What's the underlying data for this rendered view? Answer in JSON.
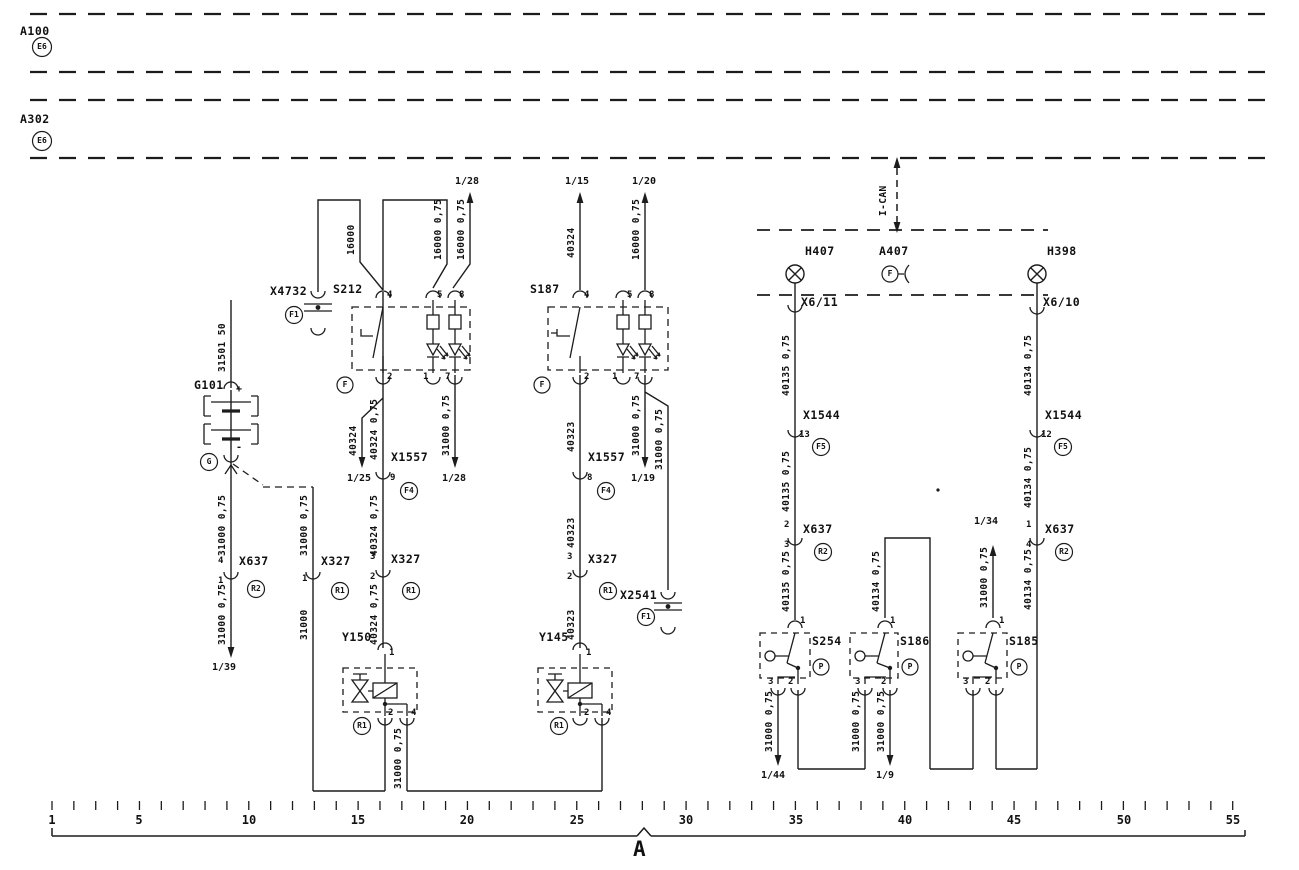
{
  "harness": {
    "a100": "A100",
    "a100_code": "E6",
    "a302": "A302",
    "a302_code": "E6",
    "ican": "I-CAN"
  },
  "page": {
    "marker": "A"
  },
  "ruler": {
    "labels": [
      "1",
      "5",
      "10",
      "15",
      "20",
      "25",
      "30",
      "35",
      "40",
      "45",
      "50",
      "55"
    ]
  },
  "lamps": {
    "h407": "H407",
    "h398": "H398",
    "a407": "A407",
    "a407_code": "F"
  },
  "connectors": {
    "x4732": {
      "label": "X4732",
      "code": "F1"
    },
    "x2541": {
      "label": "X2541",
      "code": "F1"
    },
    "x6_11": "X6/11",
    "x6_10": "X6/10",
    "x1557_l": {
      "label": "X1557",
      "pin": "9",
      "code": "F4"
    },
    "x1557_r": {
      "label": "X1557",
      "pin": "8",
      "code": "F4"
    },
    "x327_g": {
      "label": "X327",
      "pin": "1",
      "code": "R1"
    },
    "x327_l": {
      "label": "X327",
      "pin_in": "3",
      "pin_out": "2",
      "code": "R1"
    },
    "x327_r": {
      "label": "X327",
      "pin_in": "3",
      "pin_out": "2",
      "code": "R1"
    },
    "x637_g": {
      "label": "X637",
      "pin_in": "4",
      "pin_out": "1",
      "code": "R2"
    },
    "x637_m": {
      "label": "X637",
      "pin_in": "2",
      "pin_out": "3",
      "code": "R2"
    },
    "x637_r": {
      "label": "X637",
      "pin_in": "1",
      "pin_out": "4",
      "code": "R2"
    },
    "x1544_l": {
      "label": "X1544",
      "pin": "13",
      "code": "F5"
    },
    "x1544_r": {
      "label": "X1544",
      "pin": "12",
      "code": "F5"
    }
  },
  "components": {
    "g101": {
      "label": "G101",
      "code": "G",
      "plus": "+",
      "minus": "-"
    },
    "s212": {
      "label": "S212",
      "code": "F",
      "p4": "4",
      "p5": "5",
      "p8": "8",
      "p2": "2",
      "p1": "1",
      "p7": "7"
    },
    "s187": {
      "label": "S187",
      "code": "F",
      "p4": "4",
      "p5": "5",
      "p8": "8",
      "p2": "2",
      "p1": "1",
      "p7": "7"
    },
    "y150": {
      "label": "Y150",
      "code": "R1",
      "p1": "1",
      "p2": "2",
      "p4": "4"
    },
    "y145": {
      "label": "Y145",
      "code": "R1",
      "p1": "1",
      "p2": "2",
      "p4": "4"
    },
    "s254": {
      "label": "S254",
      "code": "P",
      "p1": "1",
      "p3": "3",
      "p2": "2"
    },
    "s186": {
      "label": "S186",
      "code": "P",
      "p1": "1",
      "p3": "3",
      "p2": "2"
    },
    "s185": {
      "label": "S185",
      "code": "P",
      "p1": "1",
      "p3": "3",
      "p2": "2"
    }
  },
  "wires": {
    "s212_feed": "16000",
    "s212_illum": "16000 0,75",
    "s212_indicator": "16000 0,75",
    "s187_switch_up": "40324",
    "s187_indicator": "16000 0,75",
    "s212_branch": "40324",
    "s212_out_1": "40324 0,75",
    "s212_out_2": "40324 0,75",
    "s212_out_3": "40324 0,75",
    "s187_out_1": "40323",
    "s187_out_2": "40323",
    "s187_out_3": "40323",
    "s212_ground": "31000 0,75",
    "s187_ground": "31000 0,75",
    "s187_ground_branch": "31000 0,75",
    "battery_supply": "31501 50",
    "battery_ground_1": "31000 0,75",
    "battery_ground_2": "31000 0,75",
    "battery_ground_branch": "31000 0,75",
    "x327_ground": "31000",
    "valve_link": "31000 0,75",
    "left_col_1": "40135 0,75",
    "left_col_2": "40135 0,75",
    "left_col_3": "40135 0,75",
    "right_col_1": "40134 0,75",
    "right_col_2": "40134 0,75",
    "right_col_3": "40134 0,75",
    "mid_col": "40134 0,75",
    "s254_ground": "31000 0,75",
    "s186_ground_3": "31000 0,75",
    "s186_ground_2": "31000 0,75",
    "s185_out": "31000 0,75"
  },
  "refs": {
    "r28_top": "1/28",
    "r15": "1/15",
    "r20": "1/20",
    "r25": "1/25",
    "r28_mid": "1/28",
    "r19": "1/19",
    "r39": "1/39",
    "r44": "1/44",
    "r9": "1/9",
    "r34": "1/34"
  }
}
